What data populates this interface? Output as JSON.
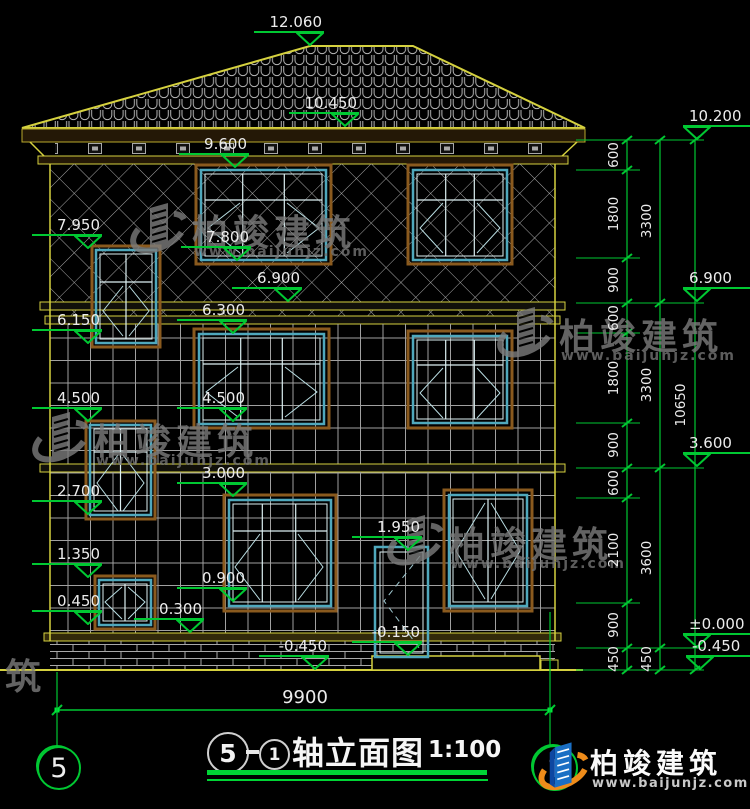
{
  "drawing": {
    "title": {
      "axis_from": "5",
      "axis_to": "1",
      "name": "轴立面图",
      "scale": "1:100"
    },
    "bottom_width_dim": "9900",
    "axis_bubbles": {
      "left": "5",
      "right": "1"
    }
  },
  "elevation_markers": [
    {
      "label": "12.060",
      "x": 310,
      "y": 46,
      "side": "L"
    },
    {
      "label": "10.450",
      "x": 345,
      "y": 127,
      "side": "L"
    },
    {
      "label": "9.600",
      "x": 235,
      "y": 168,
      "side": "L"
    },
    {
      "label": "7.950",
      "x": 88,
      "y": 249,
      "side": "L"
    },
    {
      "label": "7.800",
      "x": 237,
      "y": 261,
      "side": "L"
    },
    {
      "label": "6.900",
      "x": 288,
      "y": 302,
      "side": "L"
    },
    {
      "label": "6.300",
      "x": 233,
      "y": 334,
      "side": "L"
    },
    {
      "label": "6.150",
      "x": 88,
      "y": 344,
      "side": "L"
    },
    {
      "label": "4.500",
      "x": 88,
      "y": 422,
      "side": "L"
    },
    {
      "label": "4.500",
      "x": 233,
      "y": 422,
      "side": "L"
    },
    {
      "label": "3.000",
      "x": 233,
      "y": 497,
      "side": "L"
    },
    {
      "label": "2.700",
      "x": 88,
      "y": 515,
      "side": "L"
    },
    {
      "label": "1.950",
      "x": 408,
      "y": 551,
      "side": "L"
    },
    {
      "label": "1.350",
      "x": 88,
      "y": 578,
      "side": "L"
    },
    {
      "label": "0.900",
      "x": 233,
      "y": 602,
      "side": "L"
    },
    {
      "label": "0.450",
      "x": 88,
      "y": 625,
      "side": "L"
    },
    {
      "label": "0.300",
      "x": 190,
      "y": 633,
      "side": "L"
    },
    {
      "label": "-0.150",
      "x": 408,
      "y": 656,
      "side": "L"
    },
    {
      "label": "-0.450",
      "x": 315,
      "y": 670,
      "side": "L"
    },
    {
      "label": "10.200",
      "x": 697,
      "y": 140,
      "side": "R"
    },
    {
      "label": "6.900",
      "x": 697,
      "y": 302,
      "side": "R"
    },
    {
      "label": "3.600",
      "x": 697,
      "y": 467,
      "side": "R"
    },
    {
      "label": "±0.000",
      "x": 697,
      "y": 648,
      "side": "R"
    },
    {
      "label": "-0.450",
      "x": 700,
      "y": 670,
      "side": "R"
    }
  ],
  "dim_chains": {
    "columns": [
      {
        "x": 614,
        "labels": [
          {
            "text": "600",
            "y": 155
          },
          {
            "text": "1800",
            "y": 214
          },
          {
            "text": "900",
            "y": 280
          },
          {
            "text": "600",
            "y": 318
          },
          {
            "text": "1800",
            "y": 378
          },
          {
            "text": "900",
            "y": 445
          },
          {
            "text": "600",
            "y": 483
          },
          {
            "text": "2100",
            "y": 550
          },
          {
            "text": "900",
            "y": 625
          },
          {
            "text": "450",
            "y": 659
          }
        ]
      },
      {
        "x": 647,
        "labels": [
          {
            "text": "3300",
            "y": 221
          },
          {
            "text": "3300",
            "y": 385
          },
          {
            "text": "3600",
            "y": 558
          },
          {
            "text": "450",
            "y": 659
          }
        ]
      },
      {
        "x": 681,
        "labels": [
          {
            "text": "10650",
            "y": 405
          }
        ]
      }
    ]
  },
  "watermarks": [
    {
      "text": "柏竣建筑",
      "url": "www.baijunjz.com",
      "x": 128,
      "y": 196
    },
    {
      "text": "柏竣建筑",
      "url": "www.baijunjz.com",
      "x": 495,
      "y": 300
    },
    {
      "text": "柏竣建筑",
      "url": "www.baijunjz.com",
      "x": 30,
      "y": 405
    },
    {
      "text": "柏竣建筑",
      "url": "www.baijunjz.com",
      "x": 385,
      "y": 508
    },
    {
      "text": "建筑",
      "url": "",
      "x": -100,
      "y": 640
    }
  ],
  "logo": {
    "name": "柏竣建筑",
    "url": "www.baijunjz.com"
  }
}
